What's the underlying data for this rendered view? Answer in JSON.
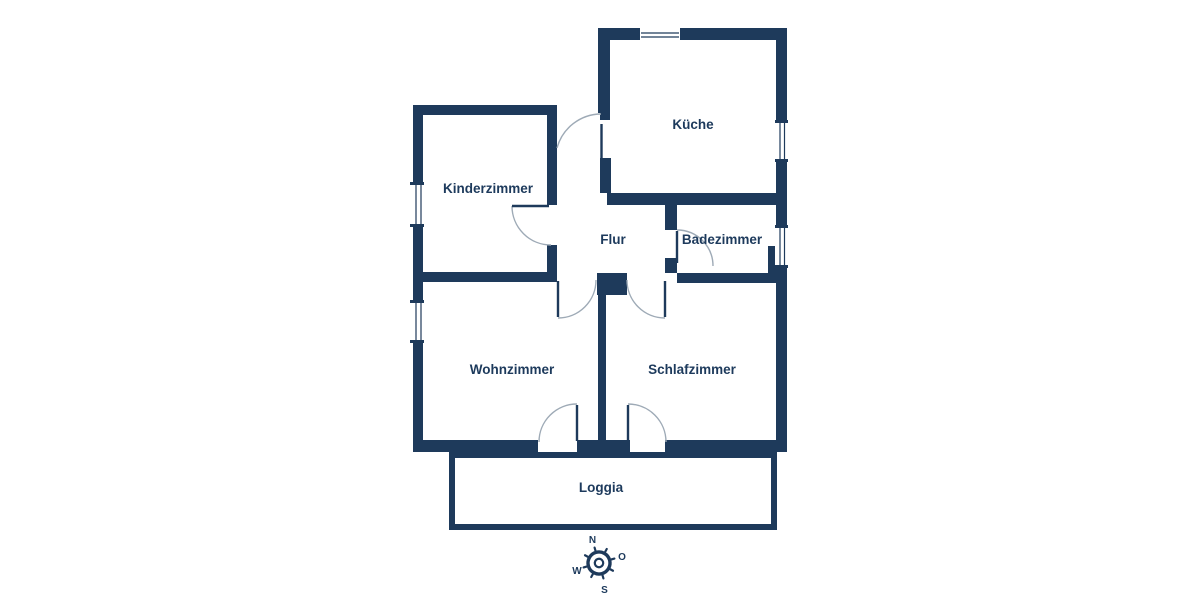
{
  "colors": {
    "wall": "#1e3a5b",
    "label": "#1d3a5c",
    "door_arc": "#9eaab6",
    "background": "#ffffff"
  },
  "floorplan": {
    "rooms": {
      "kueche": {
        "label": "Küche"
      },
      "kinderzimmer": {
        "label": "Kinderzimmer"
      },
      "flur": {
        "label": "Flur"
      },
      "badezimmer": {
        "label": "Badezimmer"
      },
      "wohnzimmer": {
        "label": "Wohnzimmer"
      },
      "schlafzimmer": {
        "label": "Schlafzimmer"
      },
      "loggia": {
        "label": "Loggia"
      }
    }
  },
  "compass": {
    "north": "N",
    "east": "O",
    "west": "W",
    "south": "S"
  }
}
